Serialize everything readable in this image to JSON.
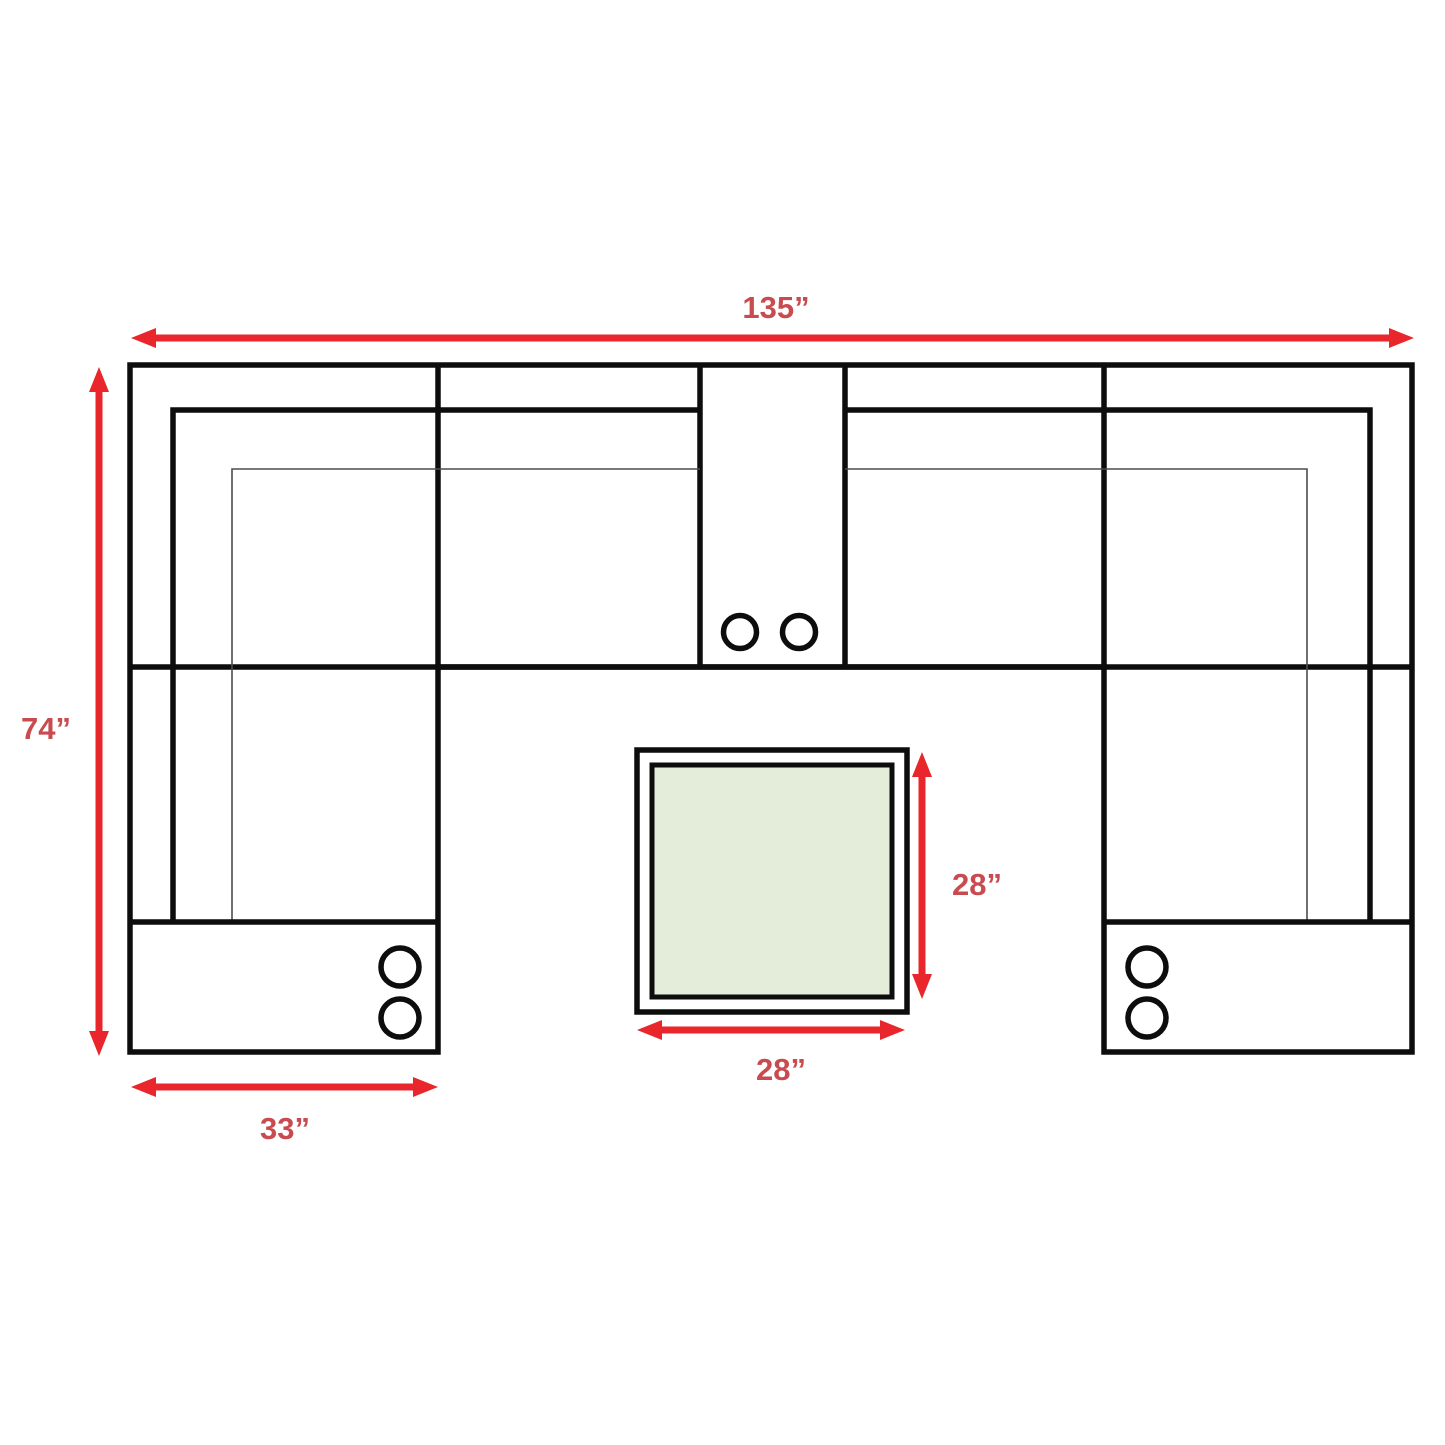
{
  "diagram": {
    "type": "furniture-dimension-floorplan",
    "description": "Top view dimension diagram of a U-shaped sectional sofa with a center console (two cupholders), two ottoman/chaise end sections with button details, and a square coffee table in the middle",
    "labels": {
      "overall_width": "135”",
      "overall_depth": "74”",
      "chaise_width": "33”",
      "table_depth": "28”",
      "table_width": "28”"
    },
    "icons": {
      "console_cupholders": "double-circle",
      "left_chaise_buttons": "double-circle",
      "right_chaise_buttons": "double-circle"
    },
    "colors": {
      "background": "#ffffff",
      "sofa_outline": "#0d0d0d",
      "thin_seam": "#4d4d4d",
      "dimension_arrow": "#e8262b",
      "dimension_label": "#c84b50",
      "table_fill": "#e4ecda"
    }
  }
}
